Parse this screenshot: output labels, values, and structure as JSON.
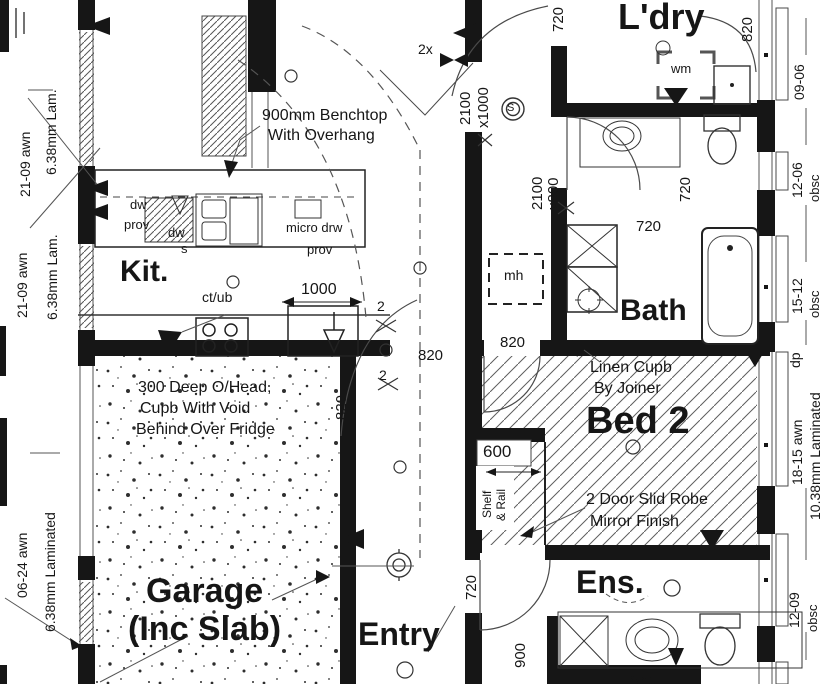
{
  "rooms": {
    "kitchen": "Kit.",
    "laundry": "L'dry",
    "bath": "Bath",
    "bed2": "Bed 2",
    "garage_line1": "Garage",
    "garage_line2": "(Inc Slab)",
    "entry": "Entry",
    "ensuite": "Ens."
  },
  "notes": {
    "benchtop_1": "900mm Benchtop",
    "benchtop_2": "With Overhang",
    "ohead_1": "300 Deep O/Head,",
    "ohead_2": "Cupb With Void",
    "ohead_3": "Behind Over Fridge",
    "linen_1": "Linen Cupb",
    "linen_2": "By Joiner",
    "robe_1": "2 Door Slid Robe",
    "robe_2": "Mirror Finish"
  },
  "fixtures": {
    "dw_label": "dw",
    "dw_prov": "prov",
    "dw2": "dw",
    "sink": "s",
    "micro": "micro drw",
    "micro_prov": "prov",
    "cooktop": "ct/ub",
    "washing_machine": "wm",
    "manhole": "mh",
    "shelf": "Shelf",
    "rail": "& Rail",
    "smoke_detector": "S",
    "shelf_partial": "Shelf"
  },
  "dims": {
    "hall_opening": "2100",
    "hall_opening_w": "x1000",
    "bath_door": "2100",
    "bath_door_w": "x800",
    "kitchen_window": "1000",
    "robe_depth": "600",
    "ens_vanity": "900",
    "door_a": "820",
    "door_b": "820",
    "door_c": "820",
    "fridge_space": "820",
    "ldry_door": "720",
    "bath_door_leaf": "720",
    "bath_internal": "720",
    "ens_door": "720",
    "qty_top": "2x",
    "qty_a": "2",
    "qty_b": "2"
  },
  "window_schedule": {
    "left": [
      {
        "size": "21-09 awn",
        "glass": "6.38mm Lam."
      },
      {
        "size": "21-09 awn",
        "glass": "6.38mm Lam."
      },
      {
        "size": "06-24 awn",
        "glass": "6.38mm Laminated"
      }
    ],
    "right": [
      {
        "size": "820"
      },
      {
        "size": "09-06"
      },
      {
        "size": "12-06",
        "glass": "obsc"
      },
      {
        "size": "15-12",
        "glass": "obsc"
      },
      {
        "size": "dp"
      },
      {
        "size": "18-15 awn",
        "glass": "10.38mm Laminated"
      },
      {
        "size": "12-09",
        "glass": "obsc"
      }
    ]
  }
}
